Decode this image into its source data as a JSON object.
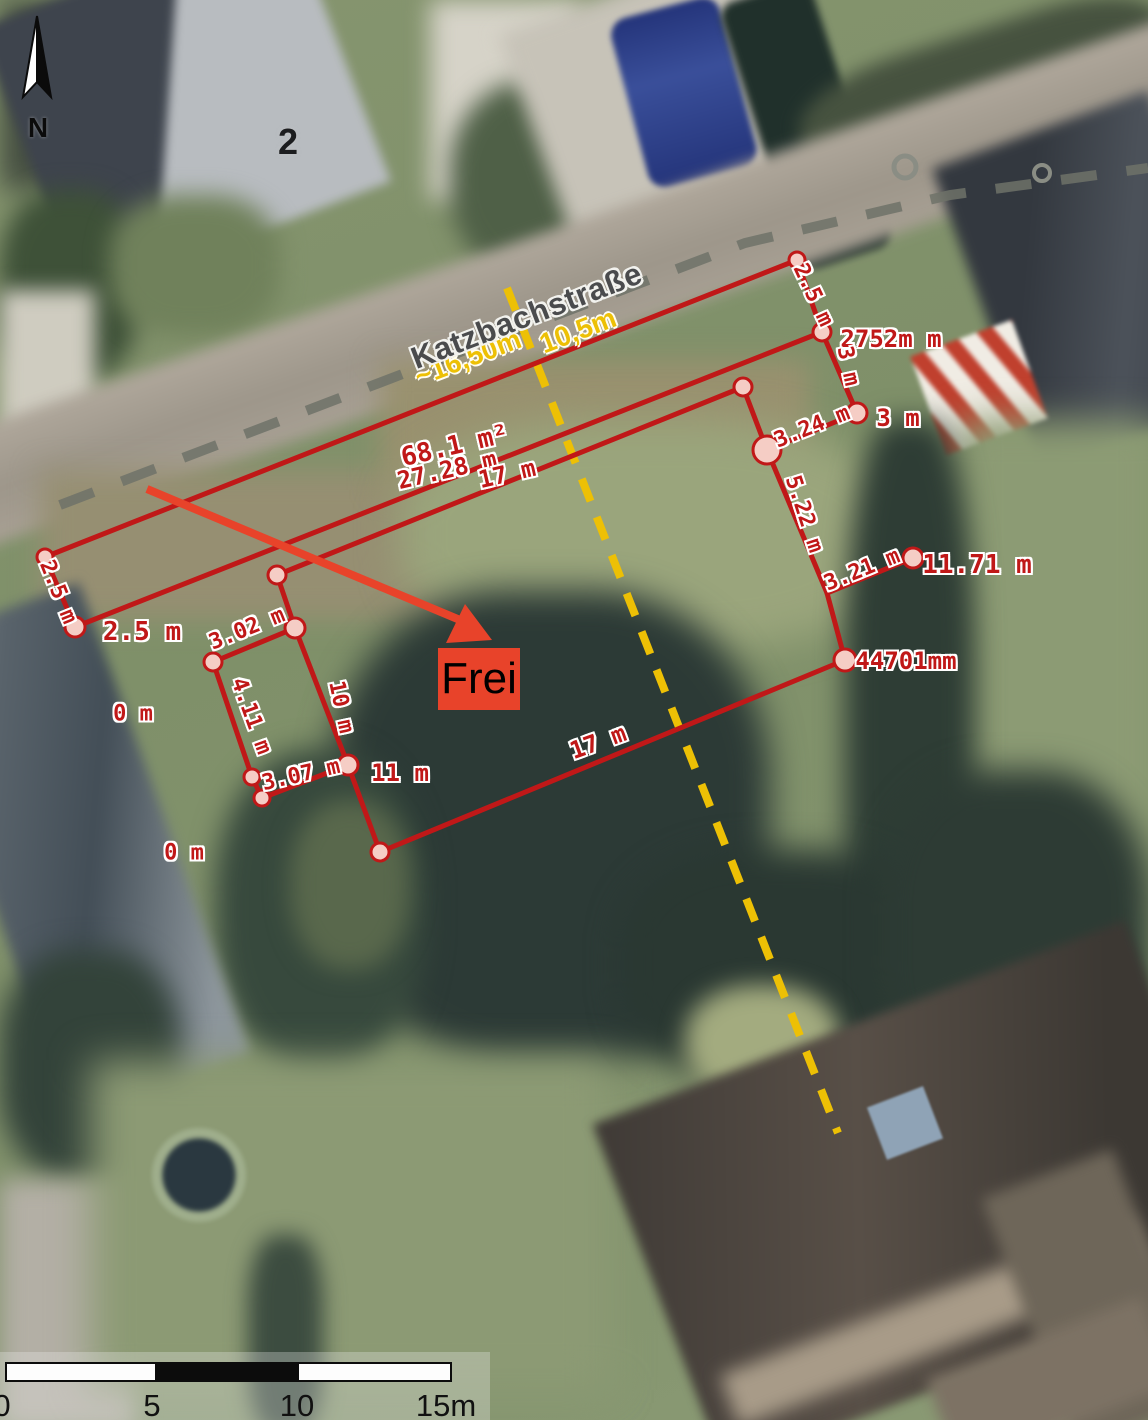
{
  "map": {
    "street_name": "Katzbachstraße",
    "house_number": "2",
    "north_label": "N",
    "colors": {
      "measurement_red": "#c01818",
      "vertex_fill": "#f5cdc5",
      "street_distance_yellow": "#edc005",
      "section_line_yellow": "#edc005",
      "arrow_orange": "#e8432a",
      "frei_box_background": "#e8432a"
    }
  },
  "annotations": {
    "frei_label": "Frei",
    "area_note": "68.1 m²",
    "measurements": [
      {
        "text": "2.5 m",
        "x": 58,
        "y": 592,
        "rot": 68,
        "size": 22
      },
      {
        "text": "2.5 m",
        "x": 142,
        "y": 632,
        "rot": 0,
        "size": 26
      },
      {
        "text": "68.1 m²",
        "x": 455,
        "y": 446,
        "rot": -13,
        "size": 26
      },
      {
        "text": "27.28 m",
        "x": 447,
        "y": 470,
        "rot": -13,
        "size": 24
      },
      {
        "text": "17 m",
        "x": 507,
        "y": 474,
        "rot": -13,
        "size": 24
      },
      {
        "text": "2.5 m",
        "x": 813,
        "y": 295,
        "rot": 65,
        "size": 22
      },
      {
        "text": "2752m m",
        "x": 891,
        "y": 339,
        "rot": 0,
        "size": 24
      },
      {
        "text": "3 m",
        "x": 848,
        "y": 366,
        "rot": 78,
        "size": 22
      },
      {
        "text": "3.24 m",
        "x": 812,
        "y": 427,
        "rot": -22,
        "size": 22
      },
      {
        "text": "3 m",
        "x": 898,
        "y": 418,
        "rot": 0,
        "size": 24
      },
      {
        "text": "5.22 m",
        "x": 804,
        "y": 514,
        "rot": 72,
        "size": 22
      },
      {
        "text": "3.21 m",
        "x": 862,
        "y": 570,
        "rot": -22,
        "size": 22
      },
      {
        "text": "11.71 m",
        "x": 977,
        "y": 565,
        "rot": 0,
        "size": 26
      },
      {
        "text": "44701mm",
        "x": 906,
        "y": 661,
        "rot": 0,
        "size": 24
      },
      {
        "text": "17 m",
        "x": 598,
        "y": 742,
        "rot": -20,
        "size": 24
      },
      {
        "text": "3.02 m",
        "x": 247,
        "y": 629,
        "rot": -22,
        "size": 22
      },
      {
        "text": "4.11 m",
        "x": 251,
        "y": 716,
        "rot": 70,
        "size": 22
      },
      {
        "text": "3.07 m",
        "x": 301,
        "y": 775,
        "rot": -13,
        "size": 22
      },
      {
        "text": "10 m",
        "x": 341,
        "y": 707,
        "rot": 78,
        "size": 22
      },
      {
        "text": "11 m",
        "x": 400,
        "y": 773,
        "rot": 0,
        "size": 24
      },
      {
        "text": "0 m",
        "x": 133,
        "y": 714,
        "rot": 0,
        "size": 22
      },
      {
        "text": "0 m",
        "x": 184,
        "y": 853,
        "rot": 0,
        "size": 22
      }
    ],
    "street_distances": [
      {
        "text": "~16,50m",
        "x": 468,
        "y": 358,
        "rot": -21
      },
      {
        "text": "10,5m",
        "x": 578,
        "y": 331,
        "rot": -21
      }
    ]
  },
  "scale_bar": {
    "ticks": [
      {
        "label": "0",
        "x": 2
      },
      {
        "label": "5",
        "x": 152
      },
      {
        "label": "10",
        "x": 297
      },
      {
        "label": "15m",
        "x": 446
      }
    ]
  }
}
